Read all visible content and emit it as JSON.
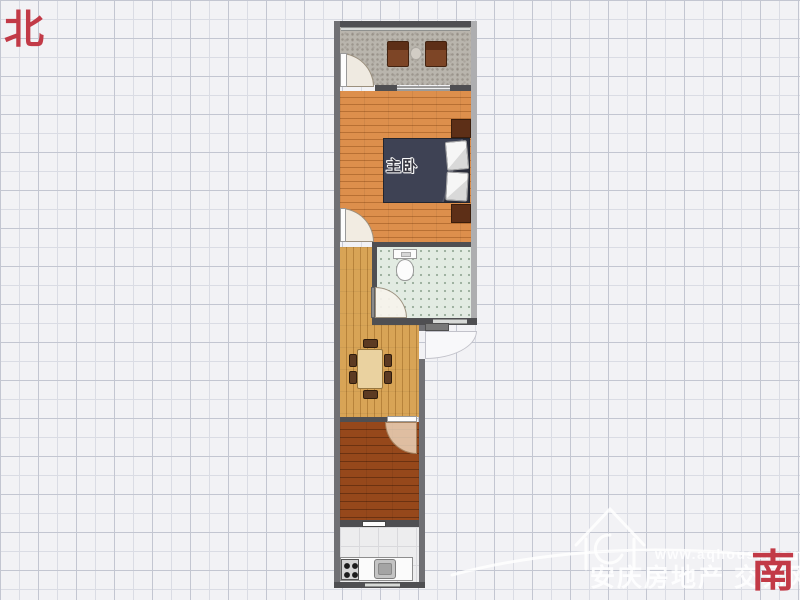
{
  "compass": {
    "north": "北",
    "south": "南"
  },
  "rooms": {
    "master_bedroom": "主卧"
  },
  "watermark": {
    "url": "www.aqhouse.com",
    "site_name": "安庆房地产 交易网"
  },
  "colors": {
    "background": "#f2f2f5",
    "grid_line": "#c3c6d1",
    "grid_line_light": "#dadce4",
    "wall_dark": "#4f4f52",
    "wall_medium": "#707074",
    "wall_light": "#aeaeb0",
    "balcony_floor": "#b9b5ad",
    "bedroom_floor": "#dd8f4c",
    "bathroom_floor": "#e2ebe2",
    "dining_floor": "#d8a456",
    "bedroom2_floor": "#96481b",
    "kitchen_floor": "#ededee",
    "bed": "#3e4254",
    "furniture_brown": "#7d4526",
    "furniture_dark": "#5d2f17",
    "compass_red": "#c23a47",
    "watermark": "rgba(255,255,255,0.85)"
  }
}
